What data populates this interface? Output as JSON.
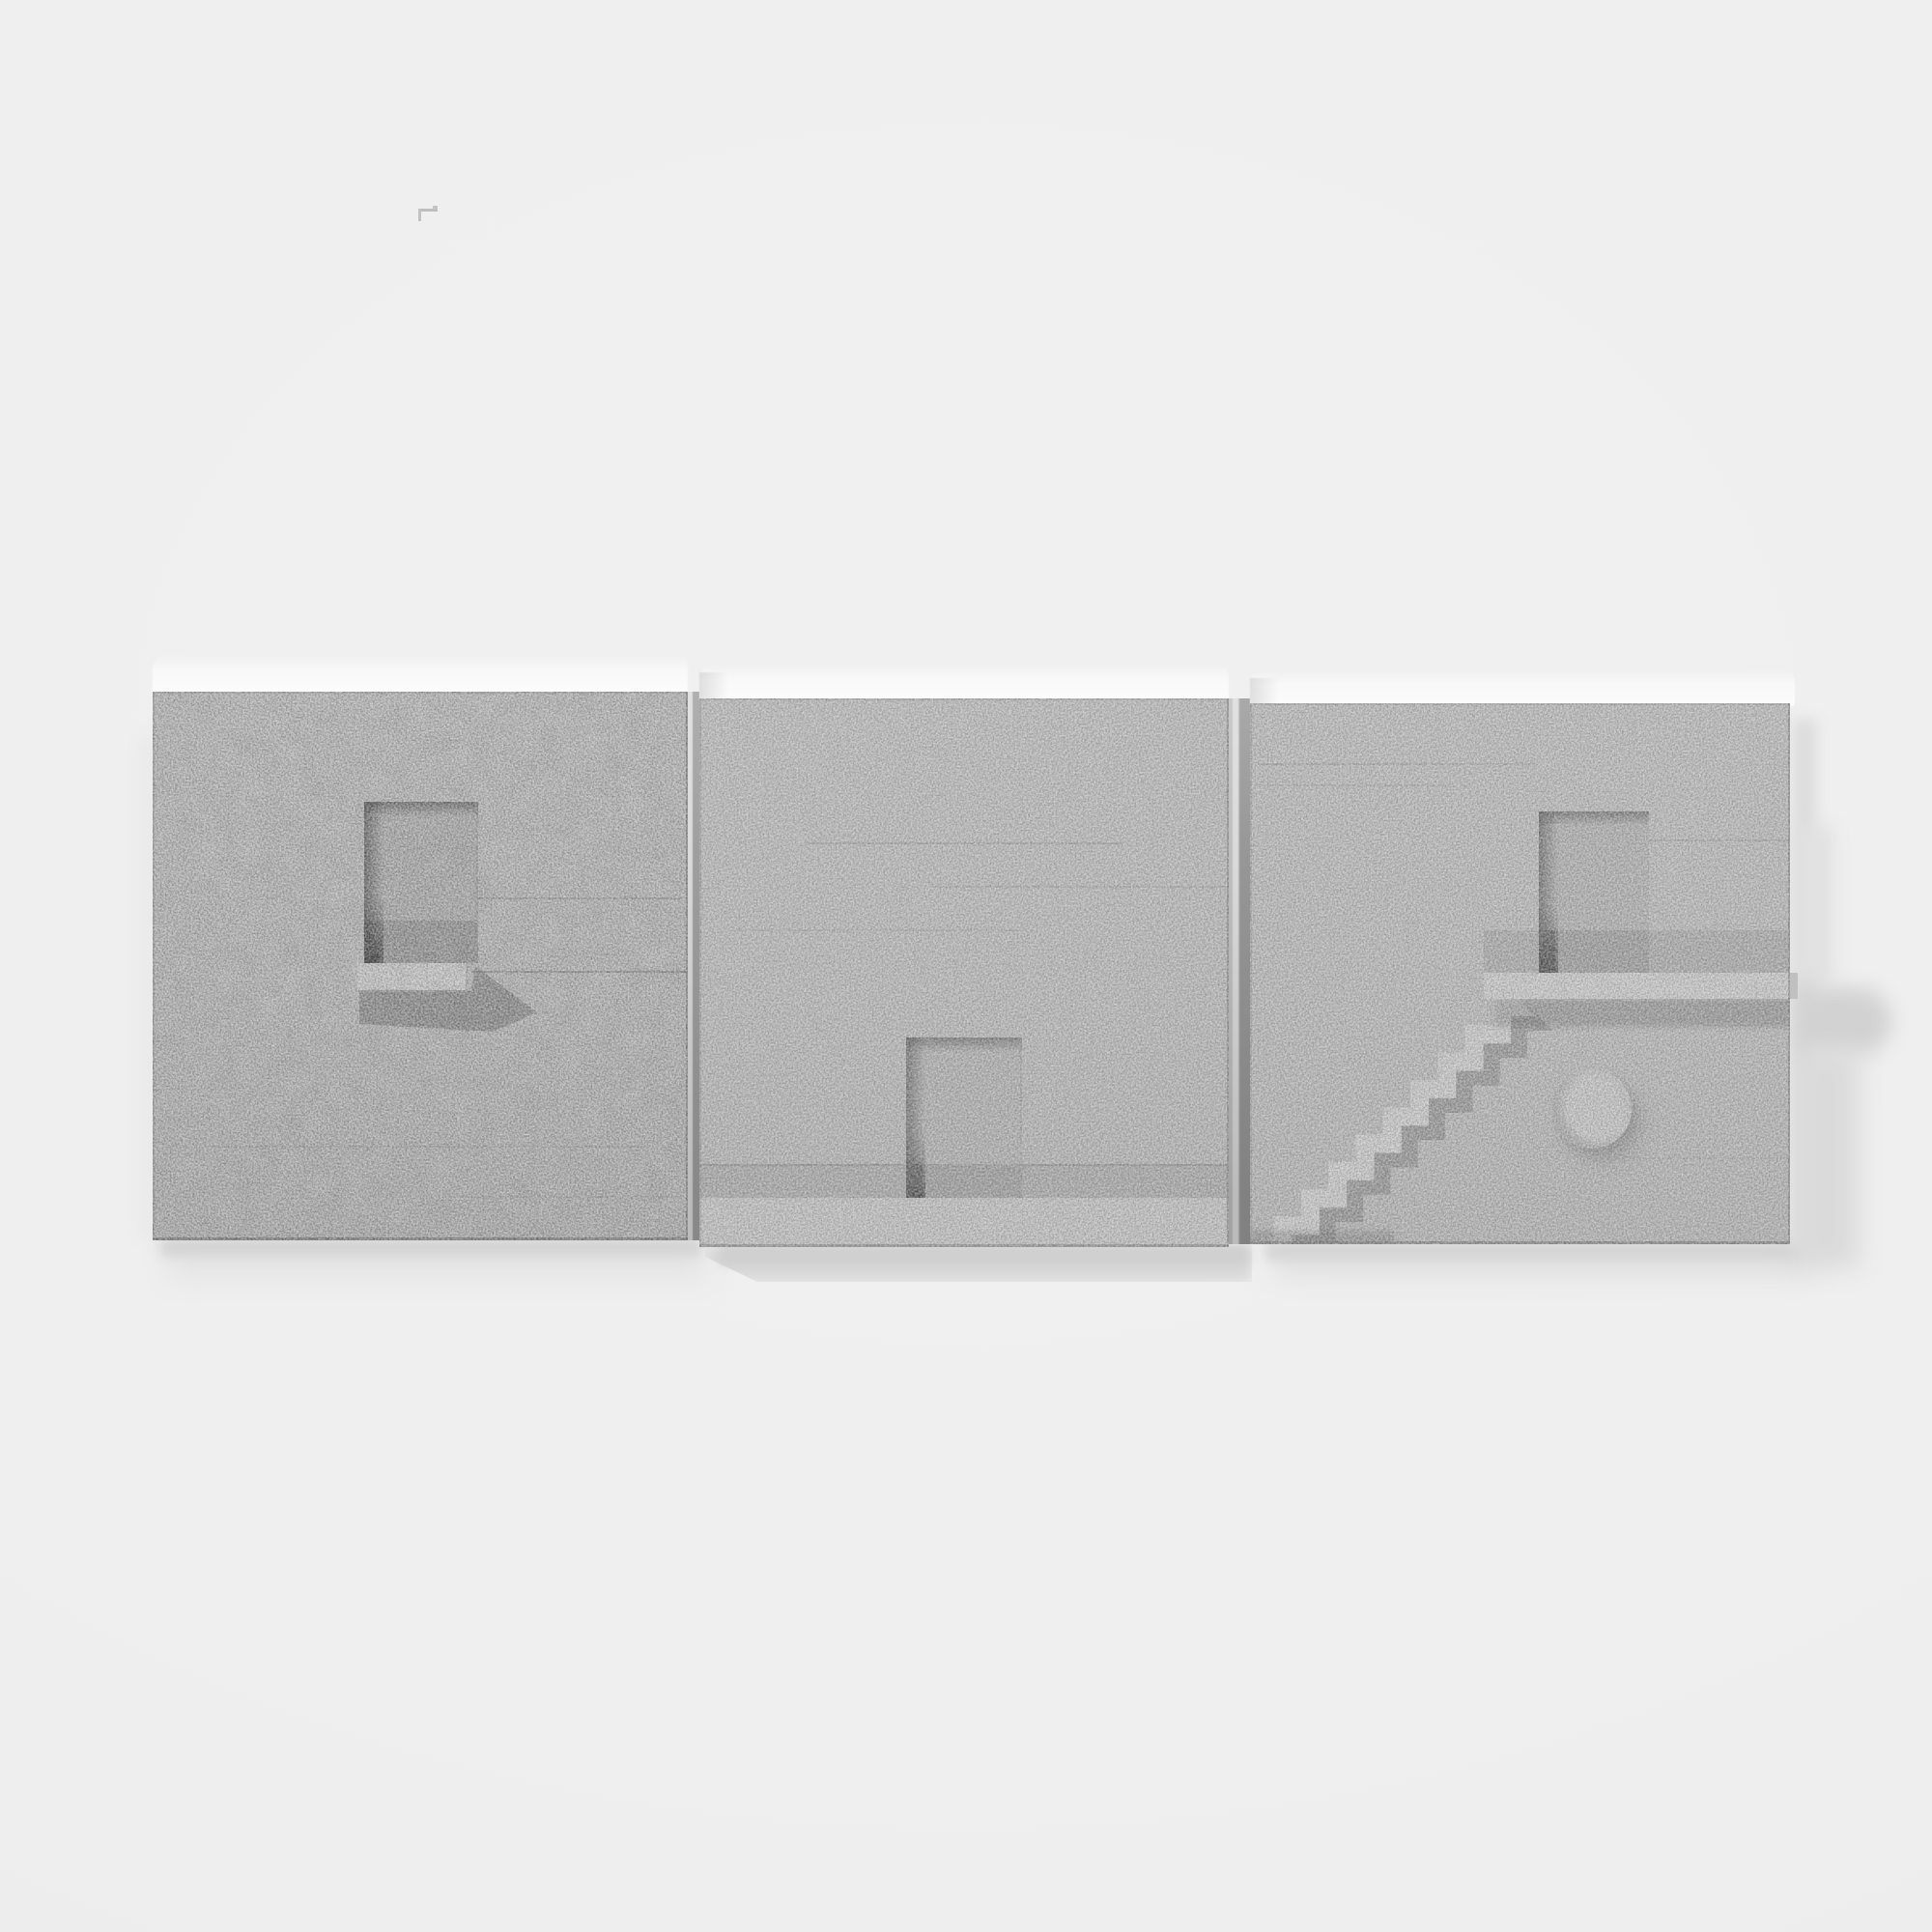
{
  "meta": {
    "domain": "photograph",
    "subject": "Three square cast-concrete architectural relief tiles mounted in a horizontal row on a white wall",
    "color_mode": "grayscale",
    "lighting": "soft daylight from upper left casting shadows down and to the right"
  },
  "palette": {
    "background": "#f0f0f0",
    "concrete": "#b4b4b4",
    "top_surface": "#fafafa",
    "recess": "#ababab",
    "recess_edge_shadow": "#6f6f6f",
    "deep_shadow": "#454545",
    "highlight": "#c6c6c6",
    "mid_shadow": "#979797",
    "wall_shadow": "#d8d8d8"
  },
  "artwork": {
    "title": "Concrete relief tile triptych",
    "tile_count": 3,
    "tiles": [
      {
        "position": "left",
        "feature": "recessed doorway niche with small projecting shelf below"
      },
      {
        "position": "middle",
        "feature": "recessed doorway behind a full-width plinth ledge along the bottom"
      },
      {
        "position": "right",
        "feature": "miniature staircase rising to a long ledge with recessed doorway above and a round concrete peg",
        "stair_steps": 9
      }
    ]
  },
  "wall_mark": {
    "description": "tiny L-shaped gray mark on the wall above the left tile"
  }
}
